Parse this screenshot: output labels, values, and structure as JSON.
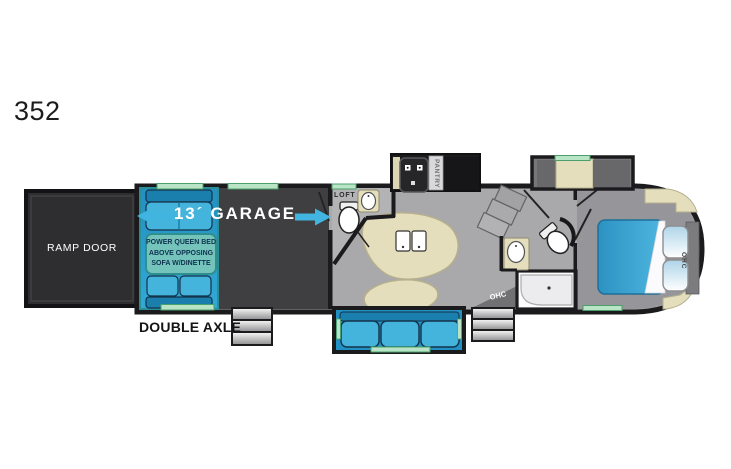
{
  "floorplan": {
    "model": "352",
    "labels": {
      "ramp_door": "RAMP DOOR",
      "garage": "13´ GARAGE",
      "garage_note": [
        "POWER QUEEN BED",
        "ABOVE OPPOSING",
        "SOFA W/DINETTE"
      ],
      "loft": "LOFT",
      "pantry": "PANTRY",
      "ohc_entry": "OHC",
      "ohc_bedroom": "OHC",
      "double_axle": "DOUBLE AXLE"
    },
    "colors": {
      "wall": "#1b1b1d",
      "garage_floor": "#3f3e40",
      "main_floor": "#a9a9ab",
      "bedroom_floor": "#96969a",
      "bath_floor": "#b3b3b5",
      "slide_fill": "#2a9fce",
      "slide_border": "#2a8e98",
      "sofa_fill": "#45b4dd",
      "sofa_dark": "#1b7fae",
      "sofa_outline": "#14324a",
      "note_fill": "#74c4bc",
      "note_border": "#2e8f8f",
      "note_text": "#10324f",
      "bed_fill": "#3aa5d6",
      "beige": "#e4debc",
      "beige_border": "#b5af8e",
      "window_green": "#b9e4c6",
      "window_green_border": "#4aa06c",
      "arrow_blue": "#41b4e0",
      "wedge_gray": "#717173",
      "ramp_black": "#2e2d2f"
    }
  }
}
